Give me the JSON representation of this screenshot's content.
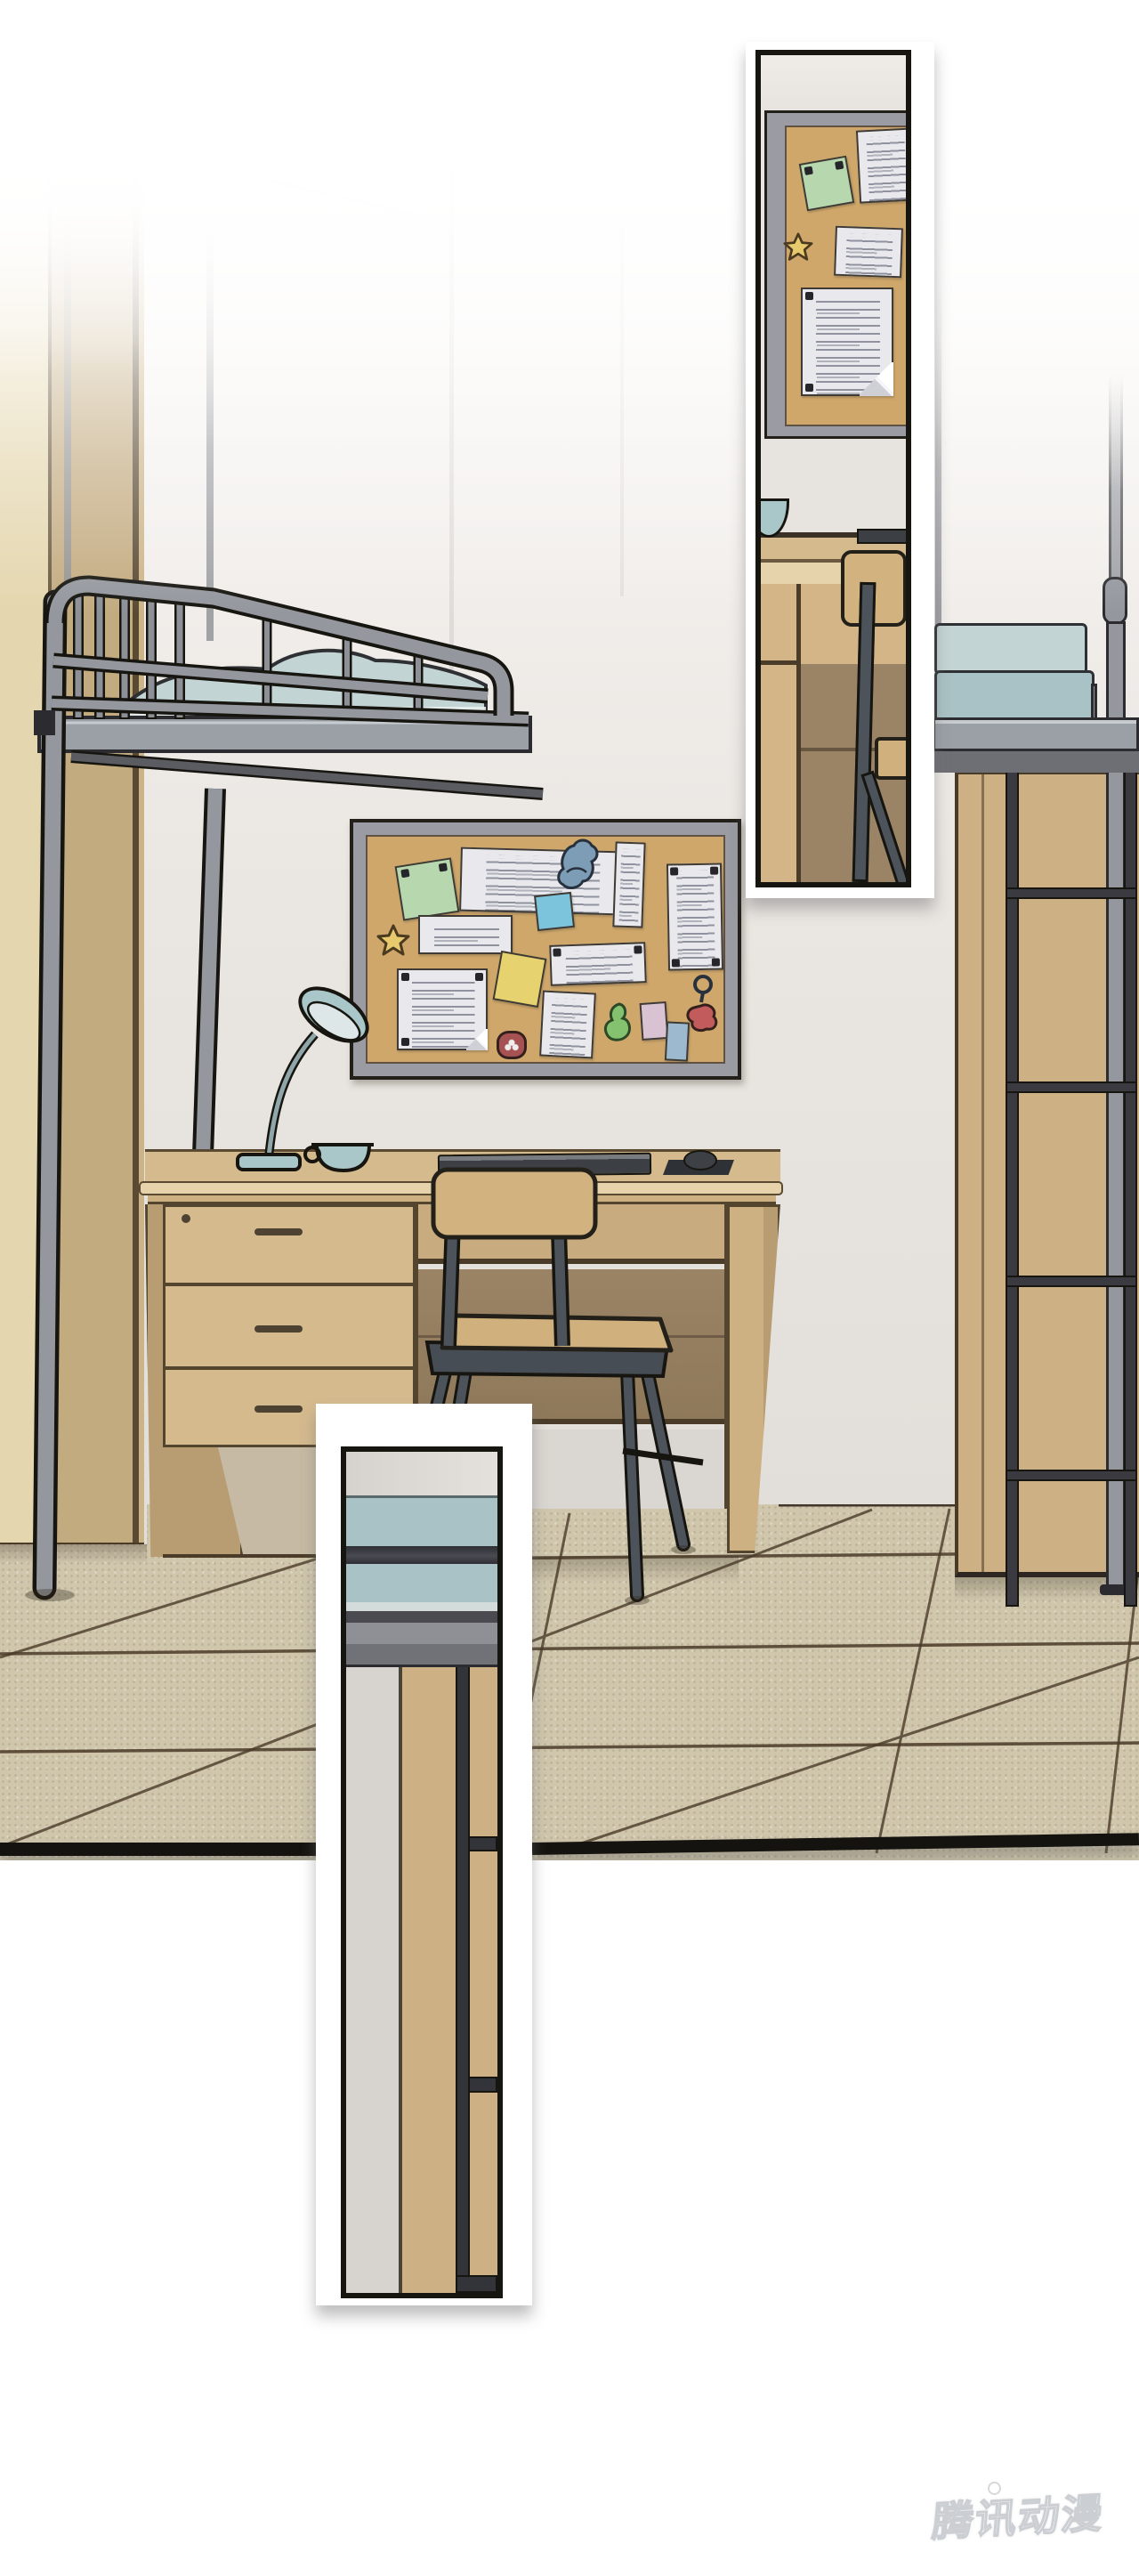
{
  "watermark": {
    "text": "腾讯动漫"
  },
  "scene": {
    "objects": [
      "loft-bed",
      "bed-ladder",
      "dorm-desk",
      "desk-chair",
      "desk-lamp",
      "tea-cup",
      "keyboard",
      "mouse",
      "corkboard",
      "wardrobe-left",
      "wardrobe-right",
      "tiled-floor",
      "folded-bedding"
    ],
    "corkboard_items": [
      "green-sticky-note",
      "white-paper-top",
      "blue-dinosaur-doodle",
      "strip-paper",
      "tall-paper",
      "star-doodle",
      "mid-paper",
      "blue-sticky-note",
      "yellow-sticky-note",
      "wide-paper",
      "big-paper-folded-corner",
      "red-flower-ornament",
      "bottom-paper",
      "green-doodle",
      "pink-card",
      "blue-card",
      "red-keychain"
    ]
  },
  "colors": {
    "ink": "#23201a",
    "line": "#4a3b28",
    "wall": "#eae6e2",
    "metal": "#94989e",
    "metal-dark": "#3a3a40",
    "metal-light": "#c6cbd0",
    "platform": "#9aa0a6",
    "platform-shadow": "#6e6e75",
    "wood": "#d5ba8e",
    "wood-light": "#e6d2ab",
    "wood-mid": "#cdb183",
    "wood-deep": "#9b8365",
    "wood-shade": "#b89c72",
    "wardrobe": "#cdb184",
    "wardrobe-left": "#e4d6ae",
    "wardrobe-left-shade": "#c3ab80",
    "cork": "#cfa76b",
    "frame-gray": "#9b9ba3",
    "teal": "#a9c2c5",
    "teal-light": "#c3d4d4",
    "sheet": "#e8eeec",
    "floor": "#cfc6ac",
    "floor-line": "#4a3b28",
    "edge-black": "#15130f",
    "paper": "#e9e9ed",
    "note-green": "#b7d7ae",
    "note-blue": "#7cc3dc",
    "note-yellow": "#e6d36f",
    "note-pink": "#d9c3d2",
    "card-blue": "#9db9cf",
    "red-ornament": "#a65252",
    "key-red": "#c25b5b",
    "doodle-blue": "#7d9cb5",
    "doodle-green": "#84c270",
    "star-yellow": "#e7ca6d",
    "keyboard": "#3c4045",
    "chair-metal": "#4d535b",
    "lamp": "#a9c6c9",
    "lamp-inner": "#dde7e7",
    "watermark-stroke": "#c9ccd0"
  }
}
